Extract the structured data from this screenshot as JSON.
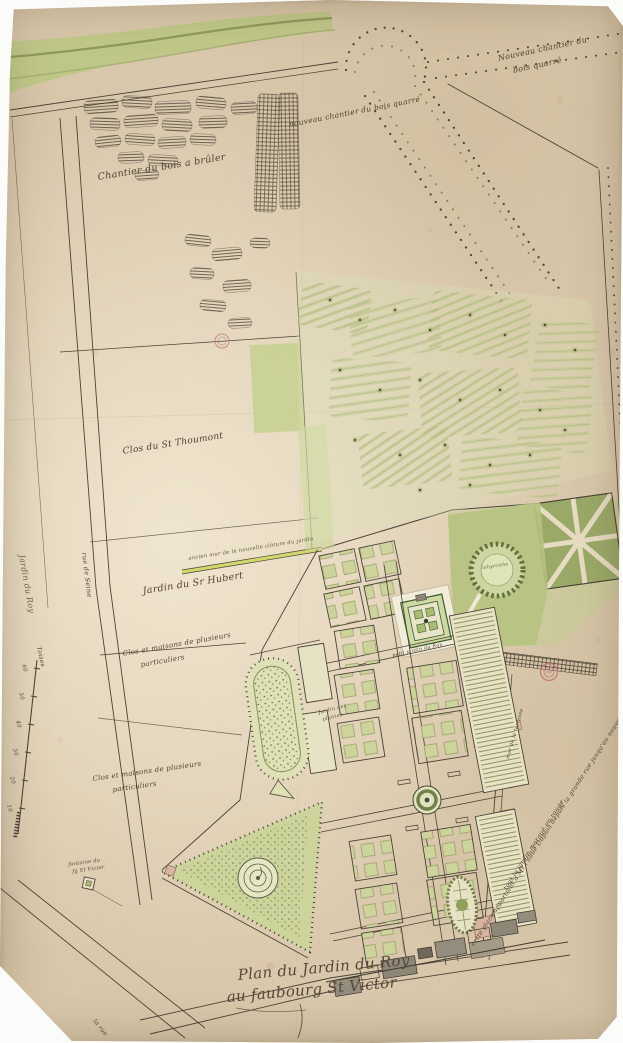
{
  "map": {
    "title": {
      "line1": "Plan du Jardin du Roy",
      "line2": "au faubourg St Victor"
    },
    "labels": {
      "woodyard": "Chantier du bois a brûler",
      "new_woodyard_left": "nouveau chantier du bois quarré",
      "new_woodyard_right_1": "Nouveau chantier du",
      "new_woodyard_right_2": "bois quarré",
      "clos_thoumont": "Clos du St Thoumont",
      "old_wall_note": "ancien mur de la nouvelle clôture du jardin",
      "jardin_hubert": "Jardin du Sr Hubert",
      "clos_particuliers_a1": "Clos et maisons de plusieurs",
      "clos_particuliers_a2": "particuliers",
      "clos_particuliers_b1": "Clos et maisons de plusieurs",
      "clos_particuliers_b2": "particuliers",
      "rue_de_seine": "rue de Seine",
      "left_edge_note": "Jardin du Roy",
      "jardin_plantes_1": "Jardin des",
      "jardin_plantes_2": "plantes",
      "petit_jardin": "petit jardin du Roy",
      "labyrinthe": "labyrinthe",
      "fontaine_1": "fontaine du",
      "fontaine_2": "fg St Victor",
      "terrace_wall": "mur de la terrasse",
      "ownership_note_1": "cette place appartient a Mr l'abbé Dupuis depuis la grande rue jusqu'au nouveau mur",
      "ownership_note_2": "tout le jardin marqué en rouge",
      "corner_street": "la rue",
      "corner_number": "13143"
    },
    "scale_bar": {
      "unit": "Toises",
      "ticks": [
        "60",
        "50",
        "40",
        "30",
        "20",
        "10"
      ]
    },
    "colors": {
      "paper": "#d8c8ac",
      "paper_light": "#ead9bf",
      "ink": "#4b4336",
      "green_wash": "#c3cc92",
      "green_dark": "#71804a",
      "stamp_pink": "#c4707f",
      "wall_red": "#d8b5a0",
      "wall_highlight": "#cdd65e"
    }
  }
}
